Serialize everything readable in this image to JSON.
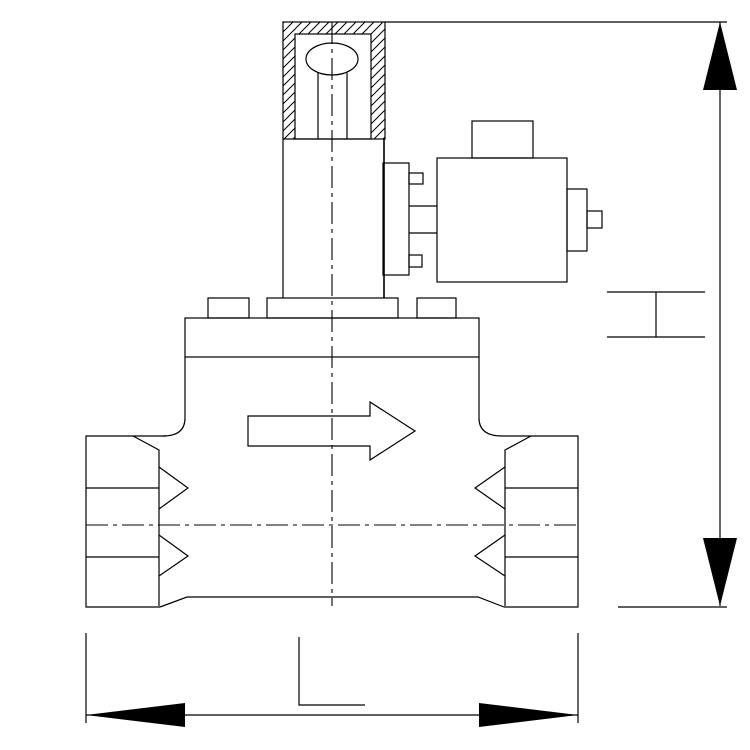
{
  "canvas": {
    "width": 750,
    "height": 750,
    "background_color": "#ffffff",
    "line_color": "#000000"
  },
  "diagram": {
    "type": "technical-line-drawing",
    "subject": "solenoid-valve-front-view-outline-drawing",
    "flow_arrow": {
      "direction": "right"
    },
    "dimensions": {
      "height": {
        "label": "H",
        "orientation": "vertical",
        "side": "right"
      },
      "length": {
        "label": "L",
        "orientation": "horizontal",
        "side": "bottom"
      }
    },
    "components": {
      "top_gland": "hatched-gland-with-core-plug",
      "stem": "armature-tube-column",
      "coil": "solenoid-coil-with-cable-connector",
      "bonnet": "bonnet-flange-with-bolt-bosses",
      "body": "valve-body",
      "left_port": "threaded-inlet-port",
      "right_port": "threaded-outlet-port"
    }
  }
}
